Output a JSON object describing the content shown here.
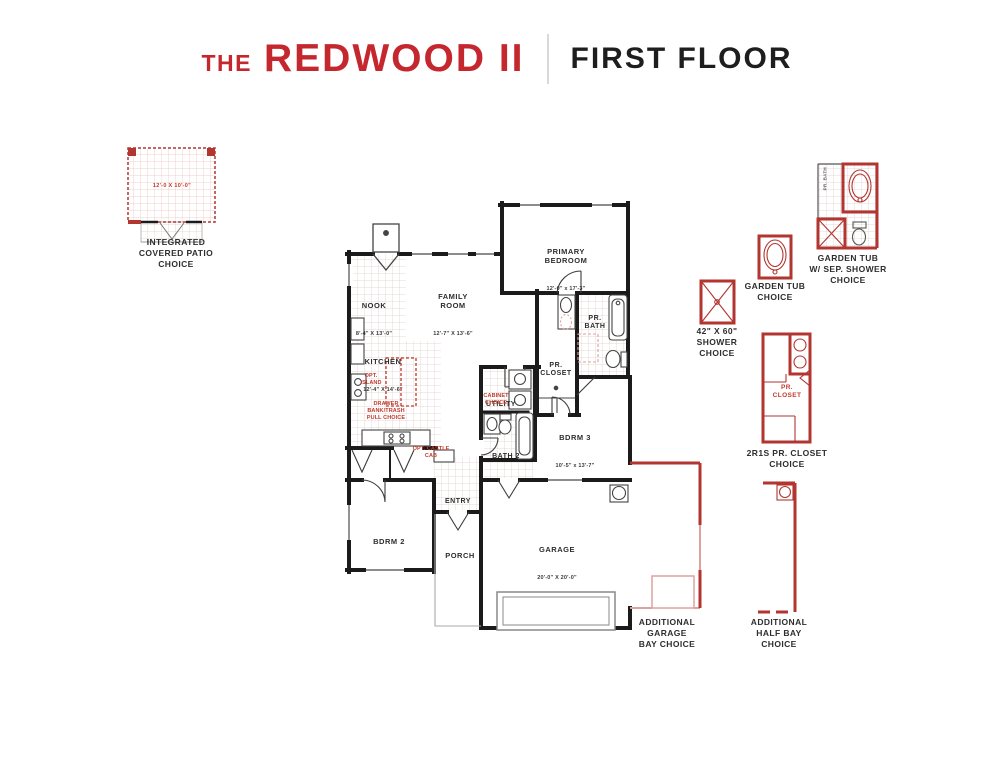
{
  "header": {
    "title_prefix": "THE",
    "title_name": "REDWOOD II",
    "subtitle": "FIRST FLOOR"
  },
  "patio": {
    "dims": "12'-0 X 10'-0\"",
    "label": "INTEGRATED\nCOVERED PATIO\nCHOICE"
  },
  "rooms": {
    "nook": {
      "name": "NOOK",
      "dims": "8'-4\" X 13'-0\""
    },
    "family": {
      "name": "FAMILY\nROOM",
      "dims": "12'-7\" X 13'-6\""
    },
    "kitchen": {
      "name": "KITCHEN",
      "dims": "12'-4\" X 14'-6\""
    },
    "primary": {
      "name": "PRIMARY\nBEDROOM",
      "dims": "12'-0\" x 17'-3\""
    },
    "pr_bath": {
      "name": "PR.\nBATH"
    },
    "pr_closet": {
      "name": "PR.\nCLOSET"
    },
    "utility": {
      "name": "UTILITY"
    },
    "bath2": {
      "name": "BATH 2"
    },
    "bdrm3": {
      "name": "BDRM 3",
      "dims": "10'-5\" x 13'-7\""
    },
    "bdrm2": {
      "name": "BDRM 2"
    },
    "entry": {
      "name": "ENTRY"
    },
    "porch": {
      "name": "PORCH"
    },
    "garage": {
      "name": "GARAGE",
      "dims": "20'-0\" X 20'-0\""
    }
  },
  "plan_options": {
    "island": "OPT.\nISLAND",
    "drawer": "DRAWER\nBANK/TRASH\nPULL CHOICE",
    "castle": "OPT. CASTLE\nCAB",
    "cabinet": "CABINET\nCHOICE"
  },
  "side_options": {
    "shower": {
      "label": "42\" X 60\"\nSHOWER\nCHOICE"
    },
    "garden_tub": {
      "label": "GARDEN TUB\nCHOICE"
    },
    "garden_tub_shower": {
      "label": "GARDEN TUB\nW/ SEP. SHOWER\nCHOICE",
      "room_tag": "PR. BATH"
    },
    "pr_closet": {
      "label": "2R1S PR. CLOSET\nCHOICE",
      "inner": "PR.\nCLOSET"
    },
    "add_garage": {
      "label": "ADDITIONAL\nGARAGE\nBAY CHOICE"
    },
    "add_half": {
      "label": "ADDITIONAL\nHALF BAY\nCHOICE"
    }
  },
  "colors": {
    "brand_red": "#c5272e",
    "plan_red": "#b23530",
    "light_red": "#dda29e",
    "wall_black": "#1b1b1b"
  }
}
